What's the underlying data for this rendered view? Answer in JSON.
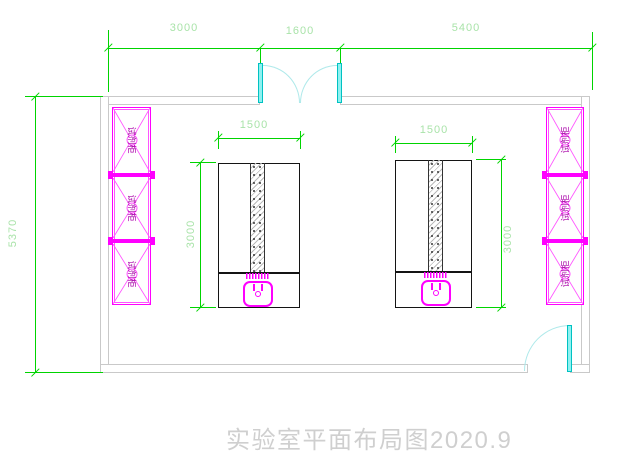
{
  "title": {
    "text": "实验室平面布局图2020.9"
  },
  "dims": {
    "top_left": "3000",
    "top_middle": "1600",
    "top_right": "5400",
    "room_height": "5370",
    "bench1_width": "1500",
    "bench1_height": "3000",
    "bench2_width": "1500",
    "bench2_height": "3000"
  },
  "cabinets": {
    "left": [
      "试剂柜",
      "试剂柜",
      "试剂柜"
    ],
    "right": [
      "试剂柜",
      "试剂柜",
      "试剂柜"
    ]
  },
  "colors": {
    "dimension_line_green": "#00d400",
    "dimension_text_green": "#a9e3a9",
    "cabinet_magenta": "#ff00ff",
    "cabinet_label_magenta": "#a800a8",
    "door_cyan": "#8ff0f0",
    "door_arc_cyan": "#aee9ea",
    "wall_gray": "#c9c9c9",
    "bench_outline_black": "#141414",
    "title_gray": "#cfcfcf",
    "background": "#ffffff"
  }
}
